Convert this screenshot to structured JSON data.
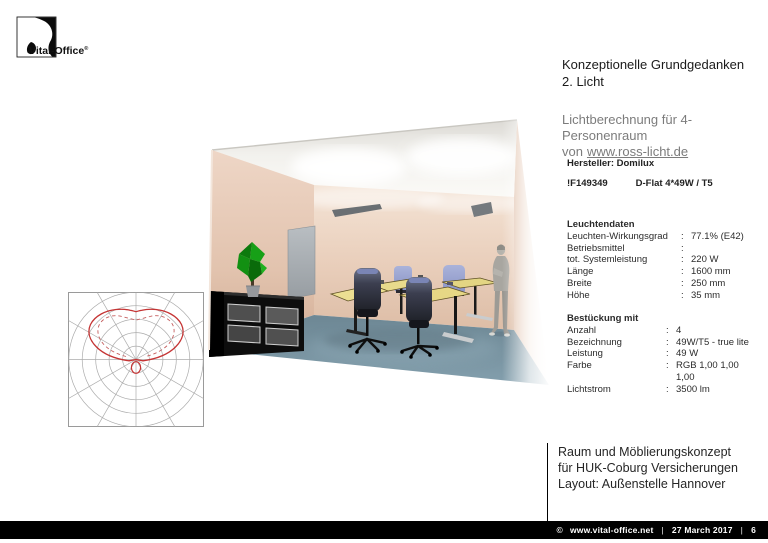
{
  "brand": {
    "logo_text": "Vital-Office",
    "registered": "®"
  },
  "header": {
    "title_line1": "Konzeptionelle Grundgedanken",
    "title_line2": "2. Licht"
  },
  "subtitle": {
    "line1": "Lichtberechnung für 4-Personenraum",
    "line2_prefix": "von",
    "link": "www.ross-licht.de"
  },
  "manufacturer": {
    "label": "Hersteller: Domilux",
    "product_code": "!F149349",
    "product_name": "D-Flat 4*49W / T5"
  },
  "luminaire_data": {
    "heading": "Leuchtendaten",
    "rows": [
      {
        "label": "Leuchten-Wirkungsgrad",
        "value": "77.1% (E42)"
      },
      {
        "label": "Betriebsmittel",
        "value": ""
      },
      {
        "label": "tot. Systemleistung",
        "value": "220 W"
      },
      {
        "label": "Länge",
        "value": "1600 mm"
      },
      {
        "label": "Breite",
        "value": "250 mm"
      },
      {
        "label": "Höhe",
        "value": "35 mm"
      }
    ]
  },
  "equipment_data": {
    "heading": "Bestückung mit",
    "rows": [
      {
        "label": "Anzahl",
        "value": "4"
      },
      {
        "label": "Bezeichnung",
        "value": "49W/T5 - true lite"
      },
      {
        "label": "Leistung",
        "value": "49 W"
      },
      {
        "label": "Farbe",
        "value": "RGB 1,00 1,00\n1,00"
      },
      {
        "label": "Lichtstrom",
        "value": "3500 lm"
      }
    ]
  },
  "project_note": {
    "line1": "Raum und Möblierungskonzept",
    "line2": "für HUK-Coburg Versicherungen",
    "line3": "Layout: Außenstelle Hannover"
  },
  "footer": {
    "copyright": "©",
    "website": "www.vital-office.net",
    "date": "27 March 2017",
    "page": "6"
  },
  "punctuation": {
    "colon": ":",
    "pipe": "|"
  },
  "polar_diagram": {
    "type": "polar-light-distribution",
    "description": "Lichtverteilungskurve of the D-Flat luminaire",
    "rings": 5,
    "radial_line_step_deg": 30,
    "grid_color": "#ababab",
    "curve_color": "#c53434",
    "curves": [
      {
        "name": "upper-main-lobe",
        "style": "solid"
      },
      {
        "name": "secondary-plane",
        "style": "dashed"
      },
      {
        "name": "small-lower-lobe",
        "style": "solid"
      }
    ]
  },
  "room_render": {
    "description": "3D rendering of a 4-person office room lit by two ceiling luminaires",
    "colors": {
      "wall": "#e6cbb8",
      "floor_carpet": "#7d98a6",
      "ceiling": "#efeeea",
      "door": "#a9aeb2",
      "table_top": "#e6d785",
      "chair_blue": "#8f9acc",
      "plant_green": "#169416",
      "sideboard": "#0d0d0d",
      "figure": "#a5a39d",
      "luminaire_panel": "#6f7478"
    }
  }
}
